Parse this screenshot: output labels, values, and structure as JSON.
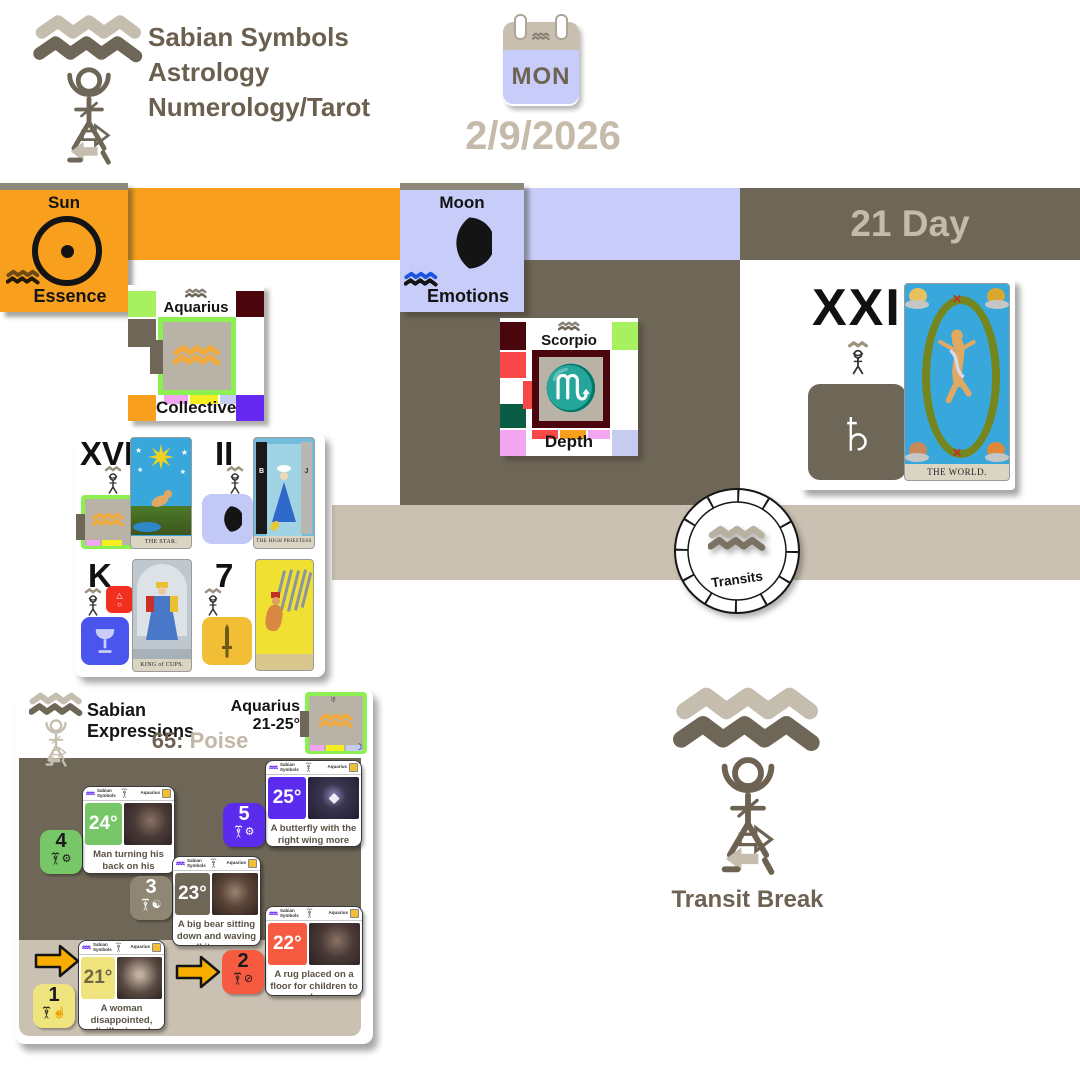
{
  "brand": {
    "title_lines": [
      "Sabian Symbols",
      "Astrology",
      "Numerology/Tarot"
    ]
  },
  "calendar": {
    "weekday": "MON"
  },
  "date_text": "2/9/2026",
  "day_header": "21 Day",
  "colors": {
    "orange": "#F8A01E",
    "taupe": "#6E6656",
    "beige_bar": "#CBC1B3",
    "lavender": "#C7CDF8",
    "muted_text": "#C6BBAB",
    "brand_text": "#6B604F"
  },
  "sun_box": {
    "title": "Sun",
    "symbol": "☉",
    "label": "Essence"
  },
  "moon_box": {
    "title": "Moon",
    "symbol": "☽",
    "label": "Emotions"
  },
  "aquarius_box": {
    "name": "Aquarius",
    "symbol": "♒",
    "label": "Collective"
  },
  "scorpio_box": {
    "name": "Scorpio",
    "symbol": "♏",
    "label": "Depth"
  },
  "world_panel": {
    "numeral": "XXI",
    "planet_symbol": "♄",
    "card_title": "THE WORLD."
  },
  "tarot": {
    "star": {
      "numeral": "XVII",
      "card_title": "THE STAR."
    },
    "high_priestess": {
      "numeral": "II",
      "card_title": "THE HIGH PRIESTESS",
      "pillar_left": "B",
      "pillar_right": "J"
    },
    "king_cups": {
      "numeral": "K",
      "card_title": "KING of CUPS."
    },
    "seven_swords": {
      "numeral": "7"
    }
  },
  "transits_wheel": {
    "label": "Transits"
  },
  "transit_break": {
    "label": "Transit Break"
  },
  "sabian": {
    "title_lines": [
      "Sabian",
      "Expressions"
    ],
    "number": "65:",
    "keyword": "Poise",
    "sign_range_lines": [
      "Aquarius",
      "21-25°"
    ],
    "card_header": {
      "brand": "Sabian Symbols",
      "sign": "Aquarius"
    },
    "degrees": [
      {
        "degree": "25°",
        "number": "5",
        "text": "A butterfly with the right wing more perfectly formed",
        "badge_color": "#5B2BEE",
        "badge_text_color": "#FFFFFF",
        "num_bg": "#5B2BEE",
        "num_color": "#FFFFFF",
        "icon_name": "mind-gear-icon",
        "icon": "⚙"
      },
      {
        "degree": "24°",
        "number": "4",
        "text": "Man turning his back on his passions teaches from his experience",
        "badge_color": "#77C668",
        "badge_text_color": "#FFFFFF",
        "num_bg": "#77C668",
        "num_color": "#1A1A1A",
        "icon_name": "machine-gear-icon",
        "icon": "⚙"
      },
      {
        "degree": "23°",
        "number": "3",
        "text": "A big bear sitting down and waving all its paws",
        "badge_color": "#6E6656",
        "badge_text_color": "#FFFFFF",
        "num_bg": "#8F8774",
        "num_color": "#FFFFFF",
        "icon_name": "yin-yang-icon",
        "icon": "☯"
      },
      {
        "degree": "22°",
        "number": "2",
        "text": "A rug placed on a floor for children to play",
        "badge_color": "#F65A41",
        "badge_text_color": "#FFFFFF",
        "num_bg": "#F65A41",
        "num_color": "#1A1A1A",
        "icon_name": "no-entry-icon",
        "icon": "⊘"
      },
      {
        "degree": "21°",
        "number": "1",
        "text": "A woman disappointed, disillusioned",
        "badge_color": "#F0E47E",
        "badge_text_color": "#6E6646",
        "num_bg": "#F0E47E",
        "num_color": "#1A1A1A",
        "icon_name": "hand-idea-icon",
        "icon": "☝"
      }
    ]
  }
}
